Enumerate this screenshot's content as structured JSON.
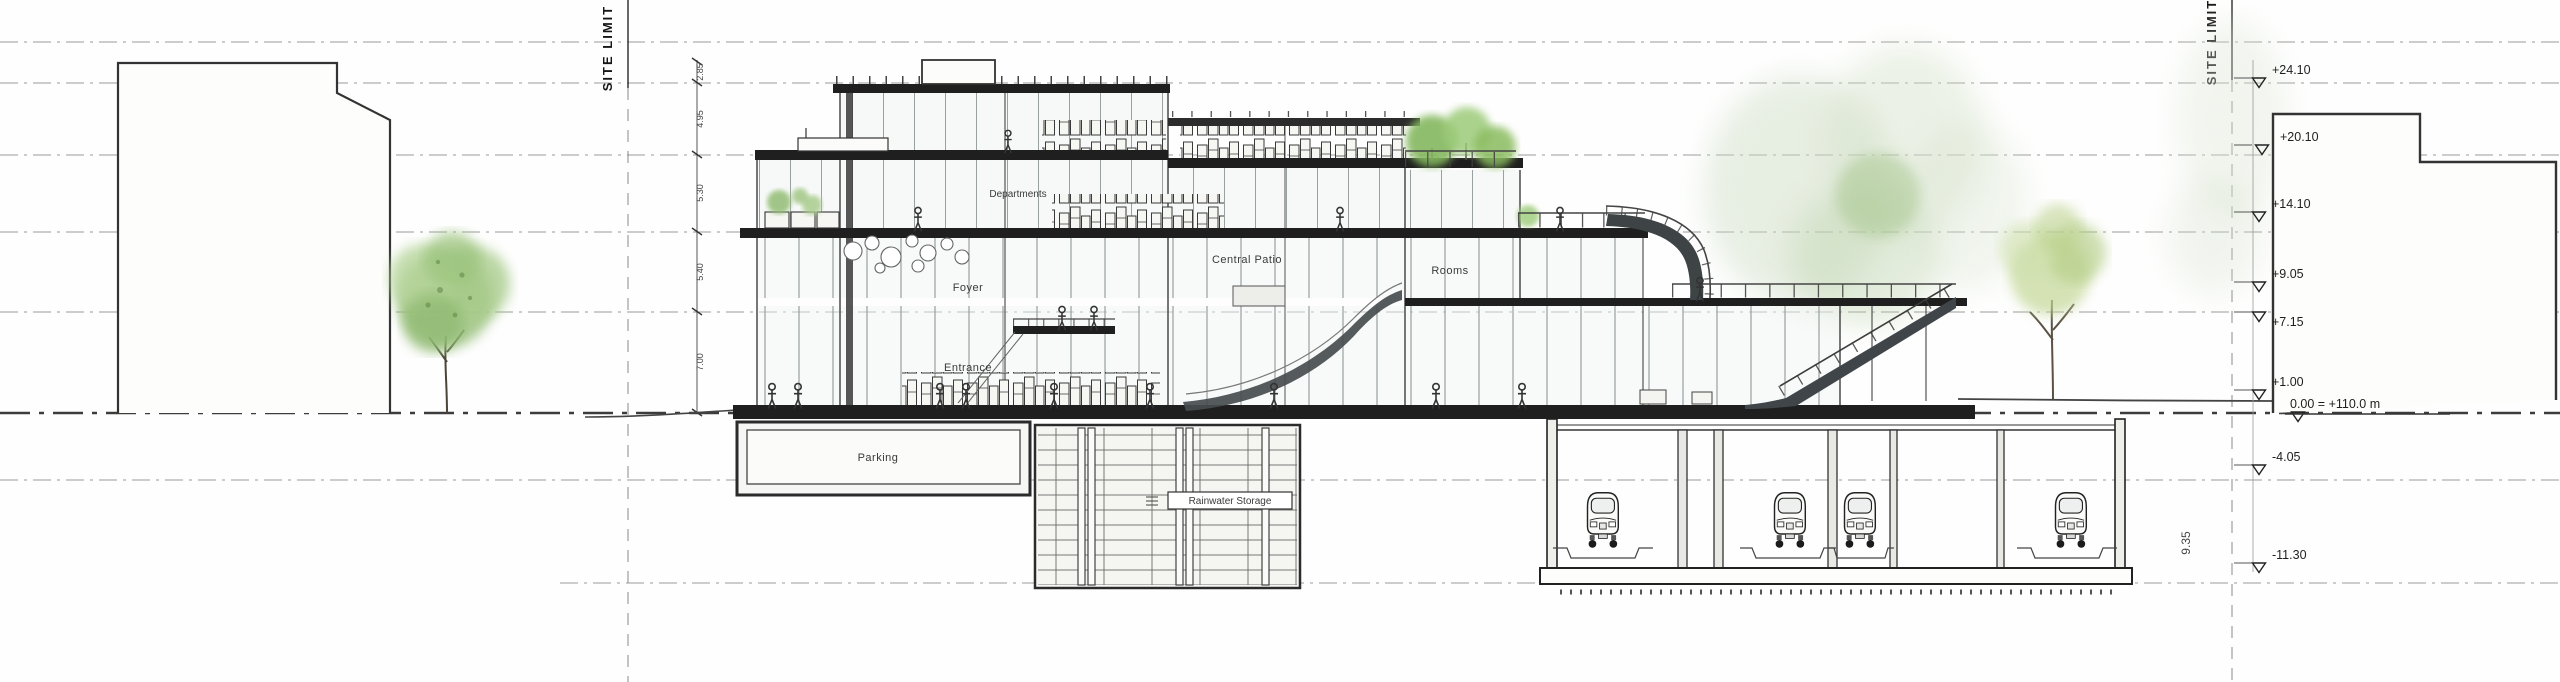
{
  "colors": {
    "tree_green": "#93bd74",
    "roof_tree_green": "#84b85e",
    "faded_tree_green": "#c3d795",
    "slab": "#1f1f1f",
    "line": "#2e2e2e",
    "glass": "#eef2f1"
  },
  "site_limits": {
    "left": "SITE LIMIT",
    "right": "SITE LIMIT"
  },
  "labels": {
    "departments": "Departments",
    "foyer": "Foyer",
    "central_patio": "Central Patio",
    "rooms": "Rooms",
    "entrance": "Entrance",
    "parking": "Parking",
    "rainwater_storage": "Rainwater Storage"
  },
  "elevation_markers": [
    {
      "value": "+24.10"
    },
    {
      "value": "+20.10"
    },
    {
      "value": "+14.10"
    },
    {
      "value": "+9.05"
    },
    {
      "value": "+7.15"
    },
    {
      "value": "+1.00"
    },
    {
      "value": "0.00 = +110.0 m"
    },
    {
      "value": "-4.05"
    },
    {
      "value": "-11.30"
    }
  ],
  "dimensions": {
    "floor_heights": [
      "2.85",
      "4.95",
      "5.30",
      "5.40",
      "7.00"
    ],
    "tunnel_depth": "9.35"
  }
}
